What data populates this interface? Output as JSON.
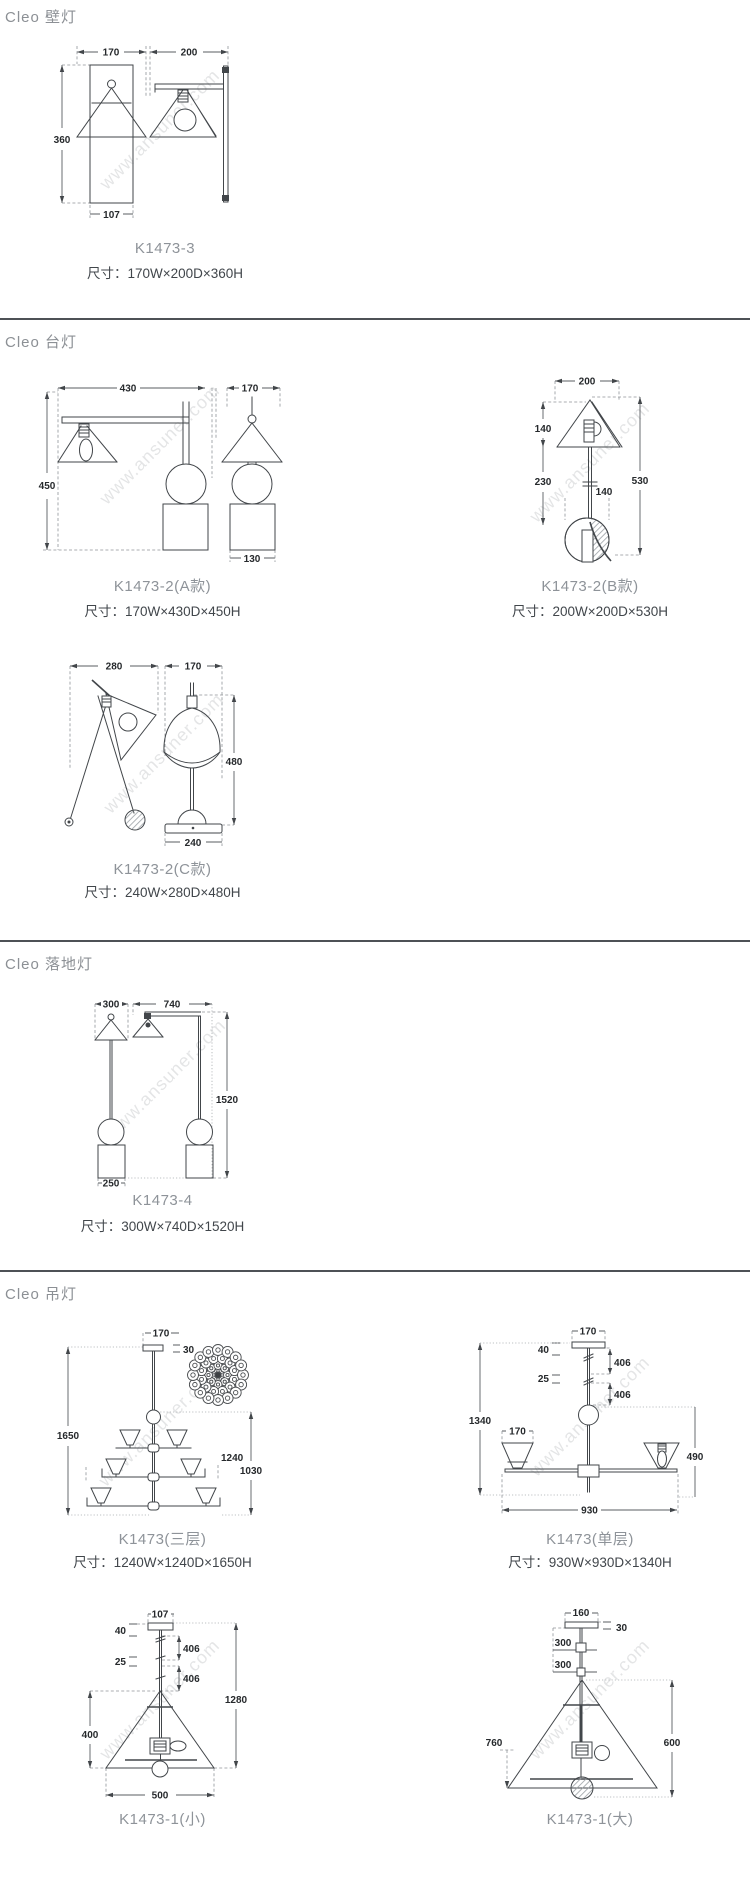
{
  "page": {
    "watermark": "www.ansuner.com"
  },
  "sections": [
    {
      "header": "Cleo 壁灯",
      "products": [
        {
          "code": "K1473-3",
          "size": "尺寸：170W×200D×360H",
          "dims": {
            "w": "170",
            "d": "200",
            "h": "360",
            "shade": "107"
          }
        }
      ]
    },
    {
      "header": "Cleo 台灯",
      "products": [
        {
          "code": "K1473-2(A款)",
          "size": "尺寸：170W×430D×450H",
          "dims": {
            "d": "430",
            "w": "170",
            "h": "450",
            "base": "130"
          }
        },
        {
          "code": "K1473-2(B款)",
          "size": "尺寸：200W×200D×530H",
          "dims": {
            "w": "200",
            "shade_h": "140",
            "rod": "230",
            "h": "530",
            "ball": "140"
          }
        },
        {
          "code": "K1473-2(C款)",
          "size": "尺寸：240W×280D×480H",
          "dims": {
            "d": "280",
            "w": "170",
            "h": "480",
            "base": "240"
          }
        }
      ]
    },
    {
      "header": "Cleo 落地灯",
      "products": [
        {
          "code": "K1473-4",
          "size": "尺寸：300W×740D×1520H",
          "dims": {
            "w": "300",
            "d": "740",
            "h": "1520",
            "base": "250"
          }
        }
      ]
    },
    {
      "header": "Cleo 吊灯",
      "products": [
        {
          "code": "K1473(三层)",
          "size": "尺寸：1240W×1240D×1650H",
          "dims": {
            "canopy": "170",
            "canopy_h": "30",
            "h": "1650",
            "w": "1240",
            "body_h": "1030"
          }
        },
        {
          "code": "K1473(单层)",
          "size": "尺寸：930W×930D×1340H",
          "dims": {
            "canopy": "170",
            "top": "40",
            "rod1": "406",
            "mid": "25",
            "rod2": "406",
            "h": "1340",
            "shade": "170",
            "body_h": "490",
            "w": "930"
          }
        },
        {
          "code": "K1473-1(小)",
          "dims": {
            "canopy": "107",
            "top": "40",
            "rod1": "406",
            "mid": "25",
            "rod2": "406",
            "h": "1280",
            "shade_h": "400",
            "w": "500"
          }
        },
        {
          "code": "K1473-1(大)",
          "dims": {
            "canopy": "160",
            "canopy_h": "30",
            "rod1": "300",
            "rod2": "300",
            "shade_w": "760",
            "shade_h": "600"
          }
        }
      ]
    }
  ]
}
